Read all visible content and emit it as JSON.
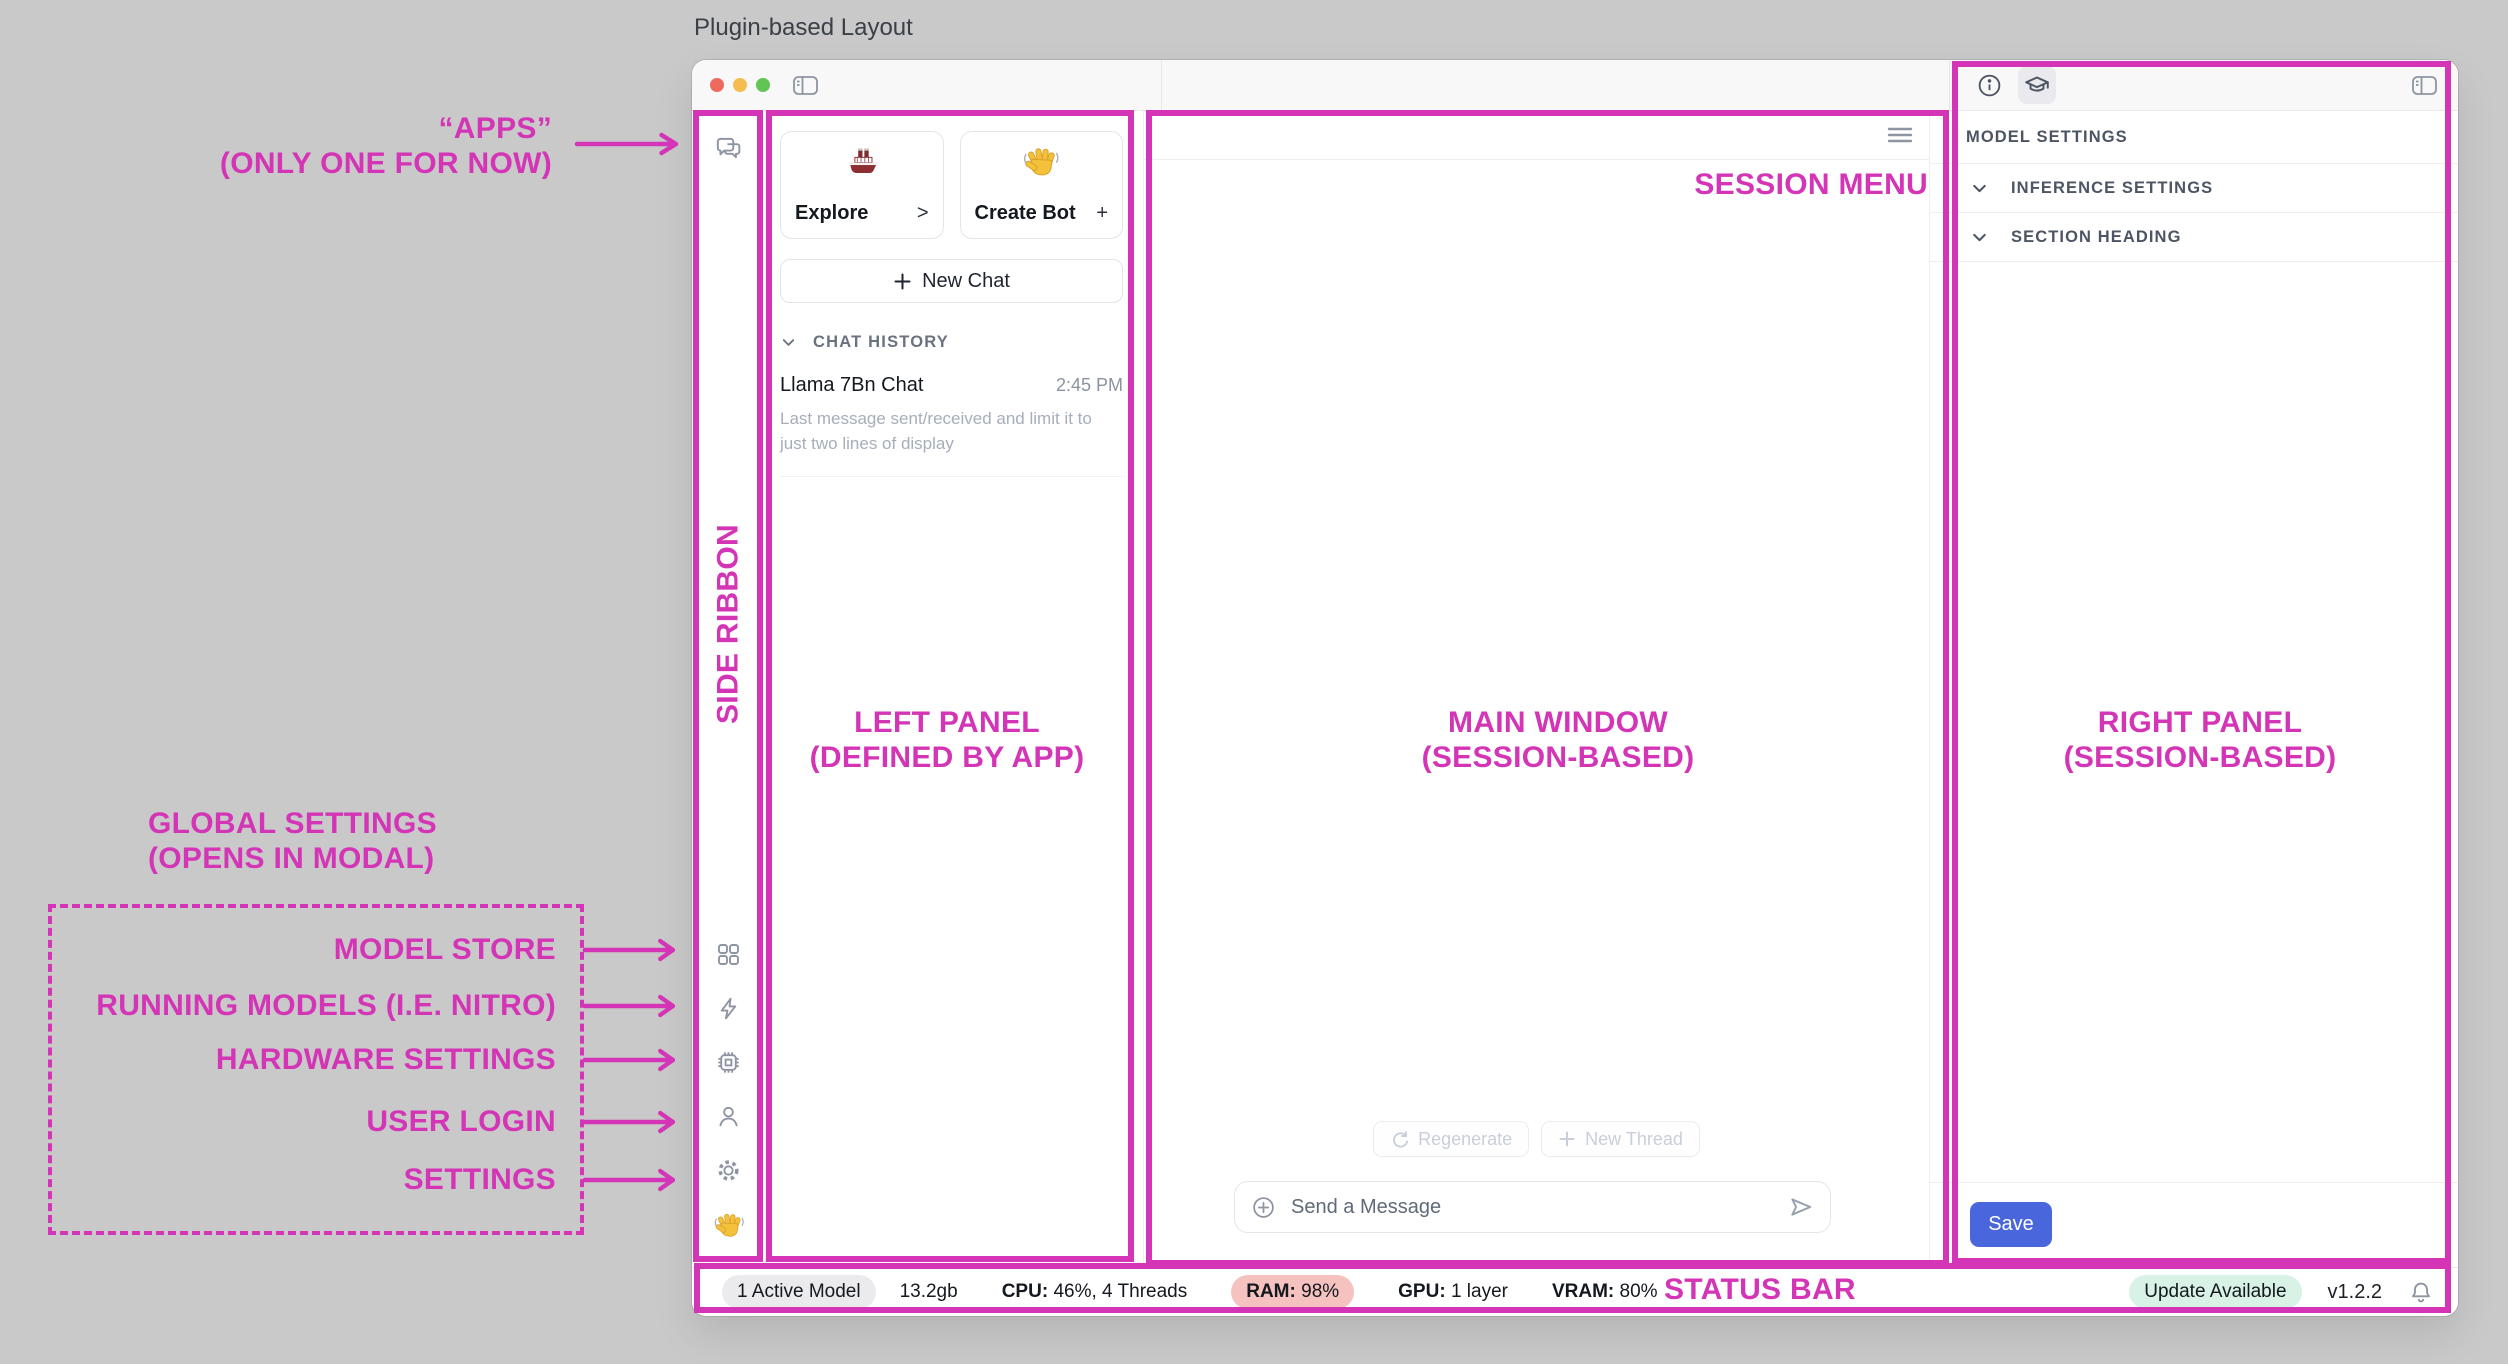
{
  "page_title": "Plugin-based Layout",
  "colors": {
    "accent_pink": "#d434b6",
    "save_blue": "#4a66dd",
    "ram_badge_bg": "#f5c2bf",
    "update_badge_bg": "#d8f3e5",
    "traffic_red": "#ee6a5e",
    "traffic_yellow": "#f5bd4f",
    "traffic_green": "#61c454"
  },
  "annotations": {
    "apps_line1": "“APPS”",
    "apps_line2": "(ONLY ONE FOR NOW)",
    "side_ribbon": "SIDE RIBBON",
    "left_panel_line1": "LEFT PANEL",
    "left_panel_line2": "(DEFINED BY APP)",
    "main_window_line1": "MAIN WINDOW",
    "main_window_line2": "(SESSION-BASED)",
    "right_panel_line1": "RIGHT PANEL",
    "right_panel_line2": "(SESSION-BASED)",
    "session_menu": "SESSION MENU",
    "status_bar": "STATUS BAR",
    "global_settings_line1": "GLOBAL SETTINGS",
    "global_settings_line2": "(OPENS IN MODAL)",
    "global_items": [
      "MODEL STORE",
      "RUNNING MODELS (I.E. NITRO)",
      "HARDWARE SETTINGS",
      "USER LOGIN",
      "SETTINGS"
    ]
  },
  "left_panel": {
    "cards": [
      {
        "icon": "ship-icon",
        "label": "Explore",
        "accessory": ">"
      },
      {
        "icon": "wave-icon",
        "label": "Create Bot",
        "accessory": "+"
      }
    ],
    "new_chat_label": "New Chat",
    "history_header": "CHAT HISTORY",
    "history_items": [
      {
        "title": "Llama 7Bn Chat",
        "time": "2:45 PM",
        "preview": "Last message sent/received and limit it to just two lines of display"
      }
    ]
  },
  "main_window": {
    "regenerate_label": "Regenerate",
    "new_thread_label": "New Thread",
    "composer_placeholder": "Send a Message"
  },
  "right_panel": {
    "sections": [
      "MODEL SETTINGS",
      "INFERENCE SETTINGS",
      "SECTION HEADING"
    ],
    "save_label": "Save"
  },
  "status_bar": {
    "active_model": "1 Active Model",
    "memory": "13.2gb",
    "cpu_label": "CPU:",
    "cpu_value": "46%, 4 Threads",
    "ram_label": "RAM:",
    "ram_value": "98%",
    "gpu_label": "GPU:",
    "gpu_value": "1 layer",
    "vram_label": "VRAM:",
    "vram_value": "80%",
    "update_badge": "Update Available",
    "version": "v1.2.2"
  }
}
